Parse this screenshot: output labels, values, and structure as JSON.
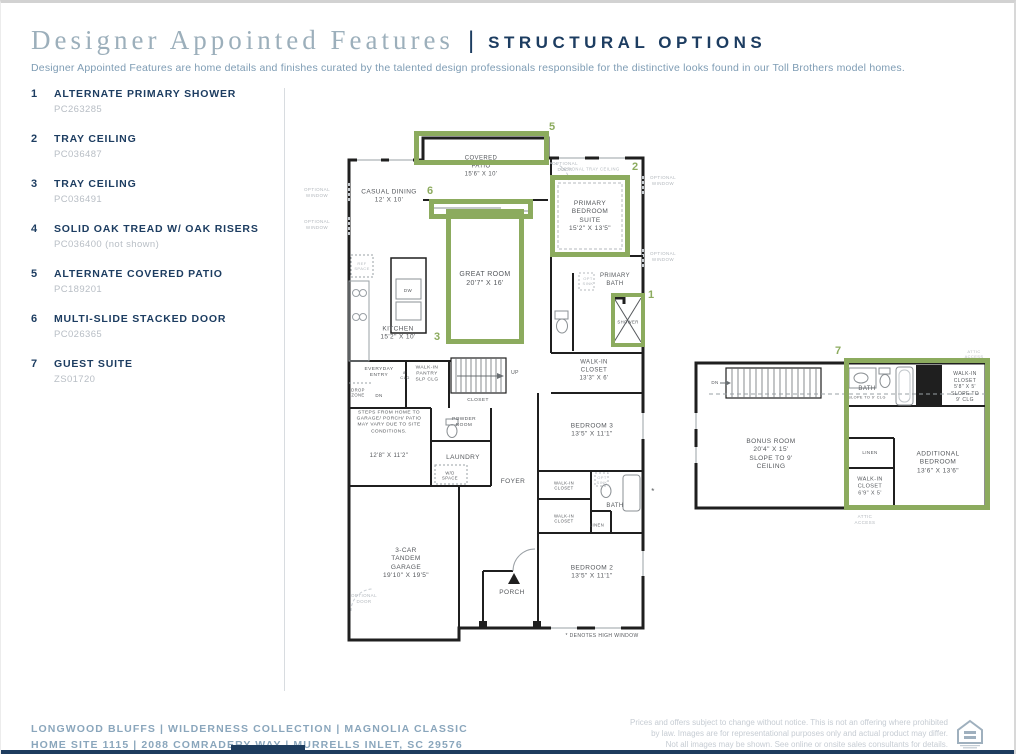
{
  "header": {
    "title": "Designer Appointed Features",
    "separator": "|",
    "section": "STRUCTURAL OPTIONS",
    "description": "Designer Appointed Features are home details and finishes curated by the talented design professionals responsible for the distinctive looks found in our Toll Brothers model homes."
  },
  "features": [
    {
      "num": "1",
      "title": "ALTERNATE PRIMARY SHOWER",
      "code": "PC263285"
    },
    {
      "num": "2",
      "title": "TRAY CEILING",
      "code": "PC036487"
    },
    {
      "num": "3",
      "title": "TRAY CEILING",
      "code": "PC036491"
    },
    {
      "num": "4",
      "title": "SOLID OAK TREAD W/ OAK RISERS",
      "code": "PC036400 (not shown)"
    },
    {
      "num": "5",
      "title": "ALTERNATE COVERED PATIO",
      "code": "PC189201"
    },
    {
      "num": "6",
      "title": "MULTI-SLIDE STACKED DOOR",
      "code": "PC026365"
    },
    {
      "num": "7",
      "title": "GUEST SUITE",
      "code": "ZS01720"
    }
  ],
  "plan1": {
    "markers": {
      "m1": "1",
      "m2": "2",
      "m3": "3",
      "m5": "5",
      "m6": "6"
    },
    "labels": {
      "covered_patio": "COVERED\nPATIO\n15'6\" X 10'",
      "optional_door": "OPTIONAL\nDOOR",
      "optional_window": "OPTIONAL\nWINDOW",
      "casual_dining": "CASUAL DINING\n12' X 10'",
      "optional_tray_ceiling": "OPTIONAL TRAY CEILING",
      "primary_bedroom": "PRIMARY\nBEDROOM\nSUITE\n15'2\" X 13'5\"",
      "great_room": "GREAT ROOM\n20'7\" X 16'",
      "kitchen": "KITCHEN\n15'2\" X 10'",
      "ref_space": "REF\nSPACE",
      "dw": "DW",
      "primary_bath": "PRIMARY\nBATH",
      "opt_sink": "OPT\nSINK",
      "shower": "SHOWER",
      "walk_in_closet_13": "WALK-IN\nCLOSET\n13'3\" X 6'",
      "everyday_entry": "EVERYDAY\nENTRY",
      "clg8": "8'\nCLG",
      "walk_in_pantry": "WALK-IN\nPANTRY\nSLP CLG",
      "up": "UP",
      "dn": "DN",
      "drop_zone": "DROP\nZONE",
      "closet": "CLOSET",
      "steps_note": "STEPS FROM HOME TO\nGARAGE/ PORCH/ PATIO\nMAY VARY DUE TO SITE\nCONDITIONS.",
      "mud_dims": "12'8\" X 11'2\"",
      "powder_room": "POWDER\nROOM",
      "laundry": "LAUNDRY",
      "wd_space": "W/D\nSPACE",
      "foyer": "FOYER",
      "bedroom3": "BEDROOM 3\n13'5\" X 11'1\"",
      "walk_in_closet": "WALK-IN\nCLOSET",
      "bath": "BATH",
      "linen": "LINEN",
      "bedroom2": "BEDROOM 2\n13'5\" X 11'1\"",
      "garage": "3-CAR\nTANDEM\nGARAGE\n19'10\" X 19'5\"",
      "porch": "PORCH",
      "high_window_note": "* DENOTES HIGH WINDOW",
      "asterisk": "*"
    }
  },
  "plan2": {
    "markers": {
      "m7": "7"
    },
    "labels": {
      "dn": "DN",
      "attic_access": "ATTIC\nACCESS",
      "bonus_room": "BONUS ROOM\n20'4\" X 15'\nSLOPE TO 9'\nCEILING",
      "bath": "BATH",
      "bath_slope": "SLOPE TO 9' CLG",
      "walk_in_closet_58": "WALK-IN\nCLOSET\n5'8\" X 5'\nSLOPE TO\n9' CLG",
      "linen": "LINEN",
      "additional_bedroom": "ADDITIONAL\nBEDROOM\n13'6\" X 13'6\"",
      "walk_in_closet_69": "WALK-IN\nCLOSET\n6'9\" X 5'"
    }
  },
  "footer": {
    "line1": "LONGWOOD BLUFFS  |  WILDERNESS COLLECTION  |  MAGNOLIA CLASSIC",
    "line2": "HOME SITE 1115  |  2088 COMRADERY WAY  |  MURRELLS INLET, SC 29576",
    "disclaimer": "Prices and offers subject to change without notice. This is not an offering where prohibited\nby law. Images are for representational purposes only and actual product may differ.\nNot all images may be shown.  See online or onsite sales consultants for details."
  },
  "colors": {
    "navy": "#1d3d61",
    "steel": "#7e9cb4",
    "green": "#8cab5e",
    "code_gray": "#b8bec5"
  }
}
